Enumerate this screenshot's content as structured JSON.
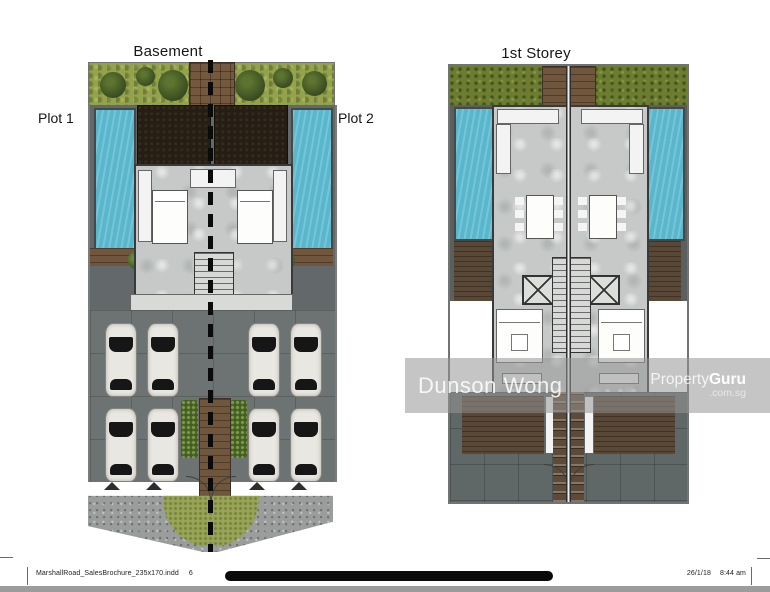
{
  "plans": {
    "basement": {
      "title": "Basement",
      "plot_left_label": "Plot 1",
      "plot_right_label": "Plot 2"
    },
    "first_storey": {
      "title": "1st Storey"
    }
  },
  "watermark": {
    "agent_name": "Dunson Wong",
    "brand": "Property",
    "brand_bold": "Guru",
    "brand_domain": ".com.sg"
  },
  "footer": {
    "document_name": "MarshallRoad_SalesBrochure_235x170.indd",
    "page_number": "6",
    "date": "26/1/18",
    "time": "8:44 am"
  },
  "colors": {
    "grass_green": "#94a24c",
    "hedge_green": "#6d7c31",
    "pool_blue": "#58b7cd",
    "soil_dark": "#241e15",
    "marble_gray": "#c6c9c7",
    "parking_gray": "#6d7372",
    "wood_brown": "#6f563c",
    "watermark_gray": "#969696"
  }
}
